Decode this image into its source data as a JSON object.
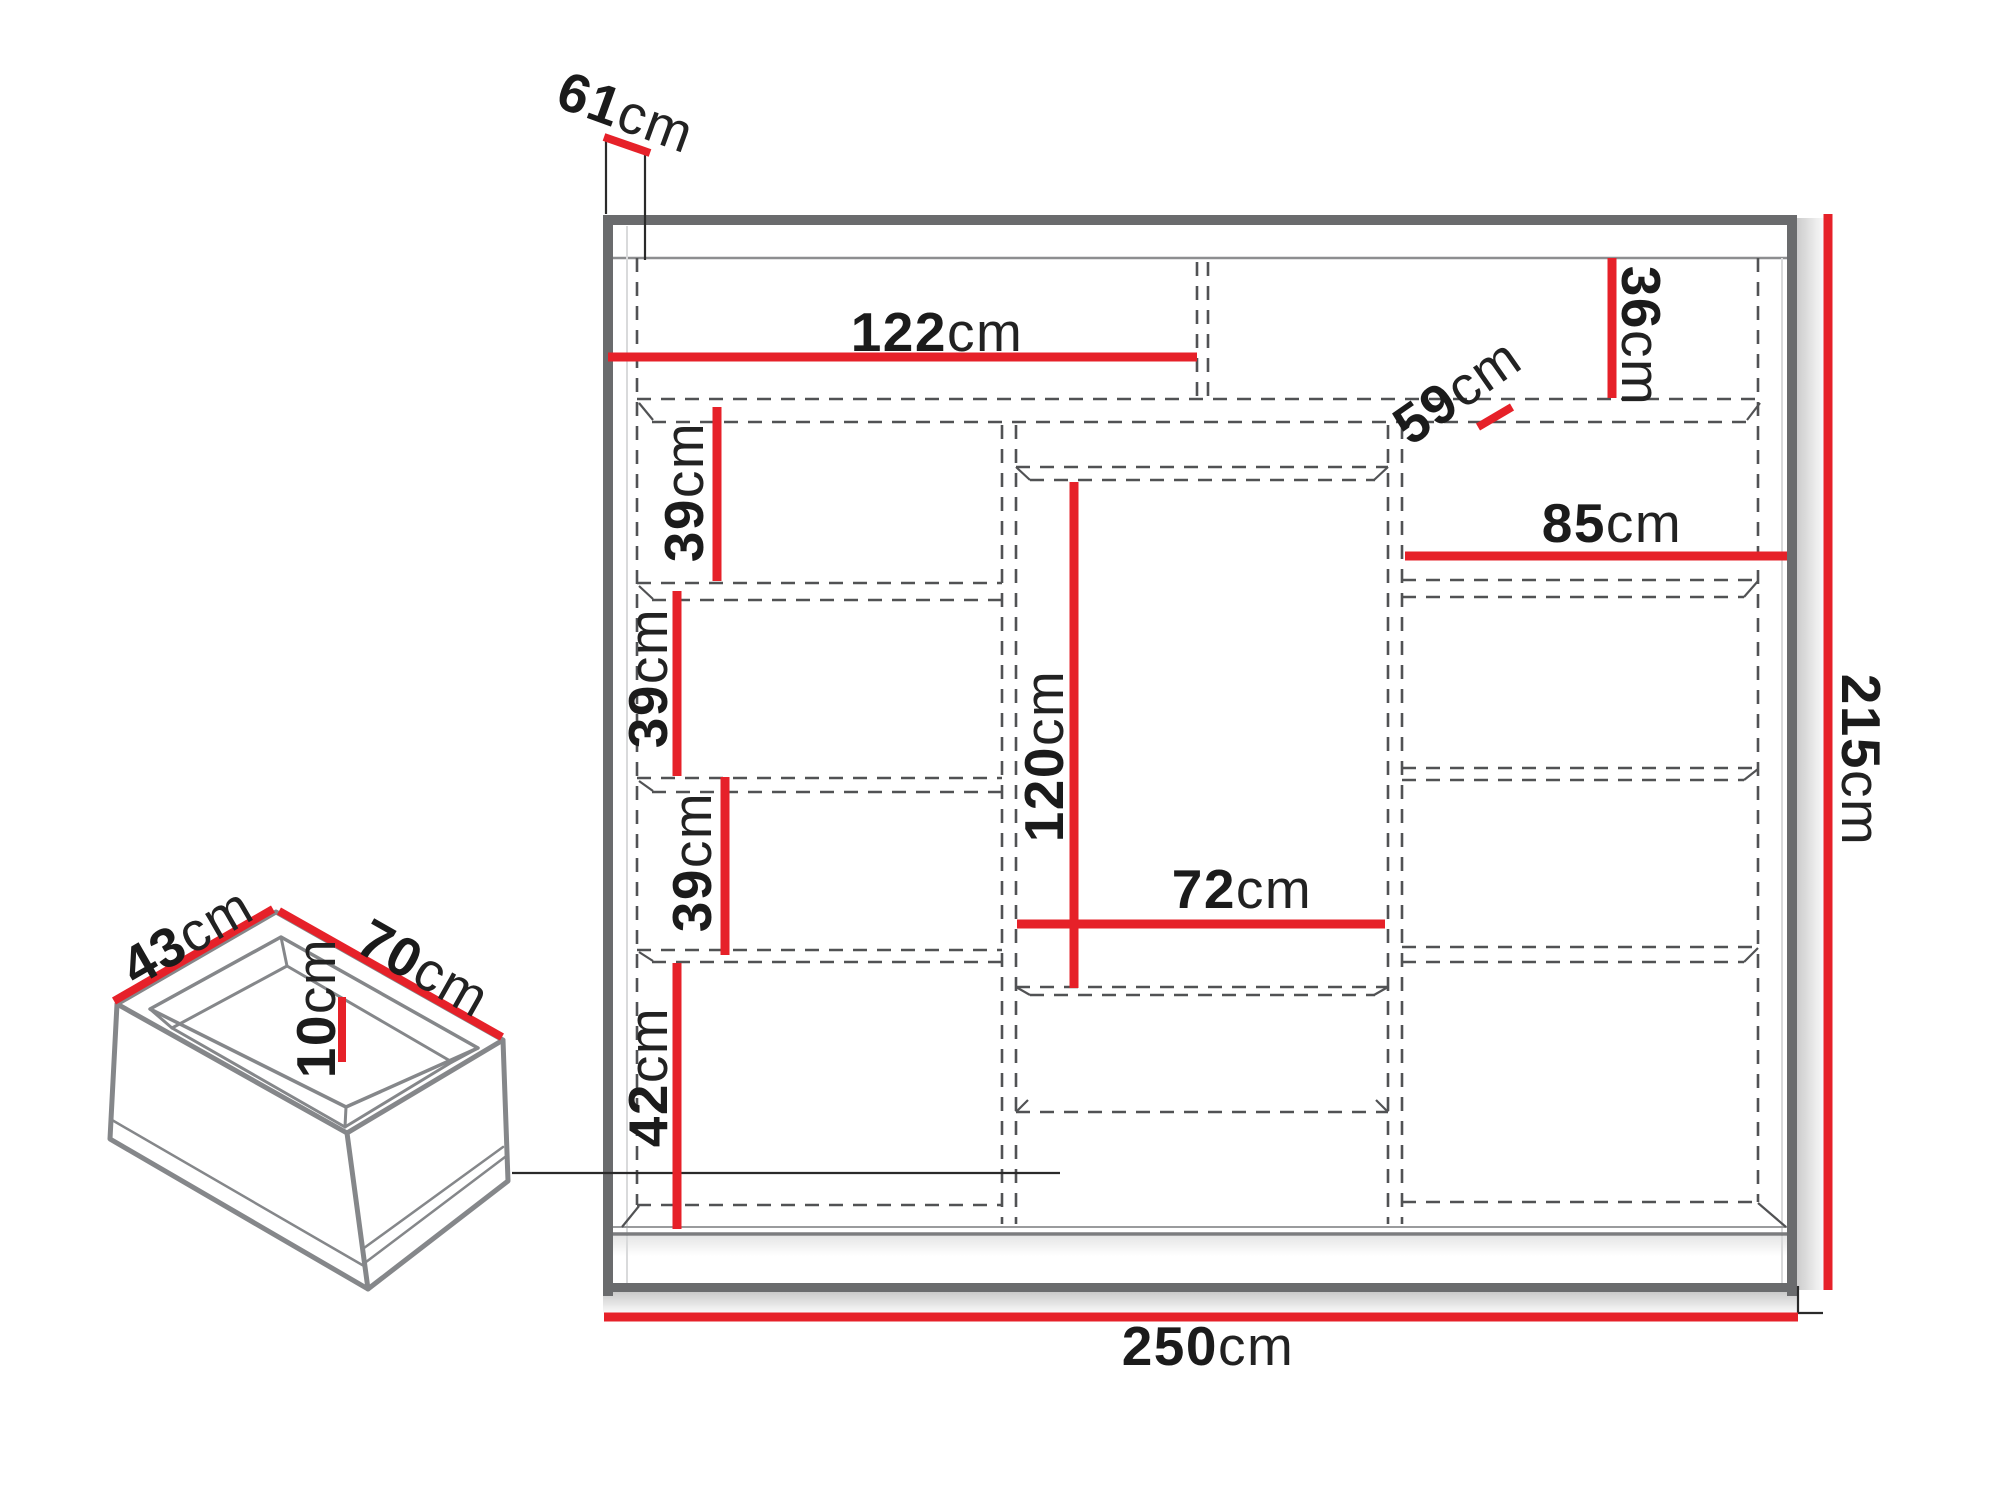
{
  "page": {
    "background": "#ffffff"
  },
  "colors": {
    "accent": "#e62129",
    "frame": "#6a6b6d",
    "dash": "#515254",
    "text": "#1b1b1b"
  },
  "wardrobe": {
    "name": "sliding wardrobe front view",
    "dimensions": {
      "total_width": {
        "value": "250",
        "unit": "cm"
      },
      "total_height": {
        "value": "215",
        "unit": "cm"
      },
      "depth": {
        "value": "61",
        "unit": "cm"
      },
      "top_shelf_width": {
        "value": "122",
        "unit": "cm"
      },
      "top_section_height": {
        "value": "36",
        "unit": "cm"
      },
      "top_right_section_width": {
        "value": "59",
        "unit": "cm"
      },
      "right_shelf_width": {
        "value": "85",
        "unit": "cm"
      },
      "left_shelf_height_1": {
        "value": "39",
        "unit": "cm"
      },
      "left_shelf_height_2": {
        "value": "39",
        "unit": "cm"
      },
      "left_shelf_height_3": {
        "value": "39",
        "unit": "cm"
      },
      "left_bottom_height": {
        "value": "42",
        "unit": "cm"
      },
      "middle_door_height": {
        "value": "120",
        "unit": "cm"
      },
      "middle_door_width": {
        "value": "72",
        "unit": "cm"
      }
    }
  },
  "drawer": {
    "name": "internal drawer isometric view",
    "dimensions": {
      "depth": {
        "value": "43",
        "unit": "cm"
      },
      "width": {
        "value": "70",
        "unit": "cm"
      },
      "height": {
        "value": "10",
        "unit": "cm"
      }
    }
  }
}
